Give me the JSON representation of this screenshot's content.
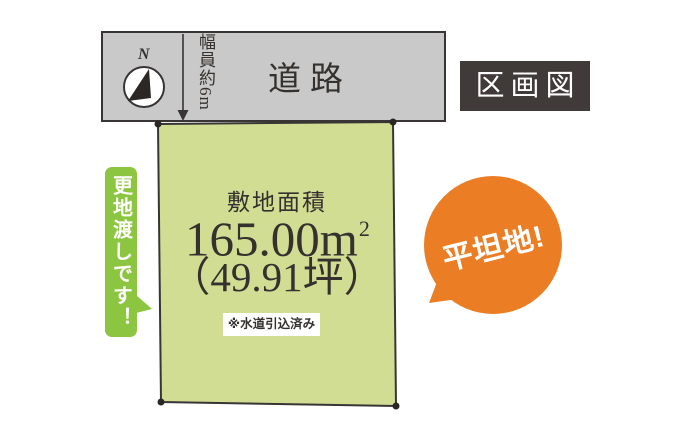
{
  "page": {
    "title_badge": "区画図"
  },
  "road": {
    "label": "道路",
    "width_note": "幅員約6m"
  },
  "compass": {
    "north_label": "N"
  },
  "plot": {
    "area_label": "敷地面積",
    "area_value": "165.00m",
    "area_exponent": "2",
    "area_tsubo": "（49.91坪）",
    "note": "※水道引込済み"
  },
  "callouts": {
    "ribbon": "更地渡しです！",
    "bubble": "平坦地!"
  },
  "colors": {
    "road-gray": "#c9c9c9",
    "plot-green": "#d2dd94",
    "ribbon-green": "#8cc540",
    "bubble-orange": "#eb7d24",
    "title-bg": "#403a39",
    "line": "#393534",
    "ink": "#35312e"
  }
}
